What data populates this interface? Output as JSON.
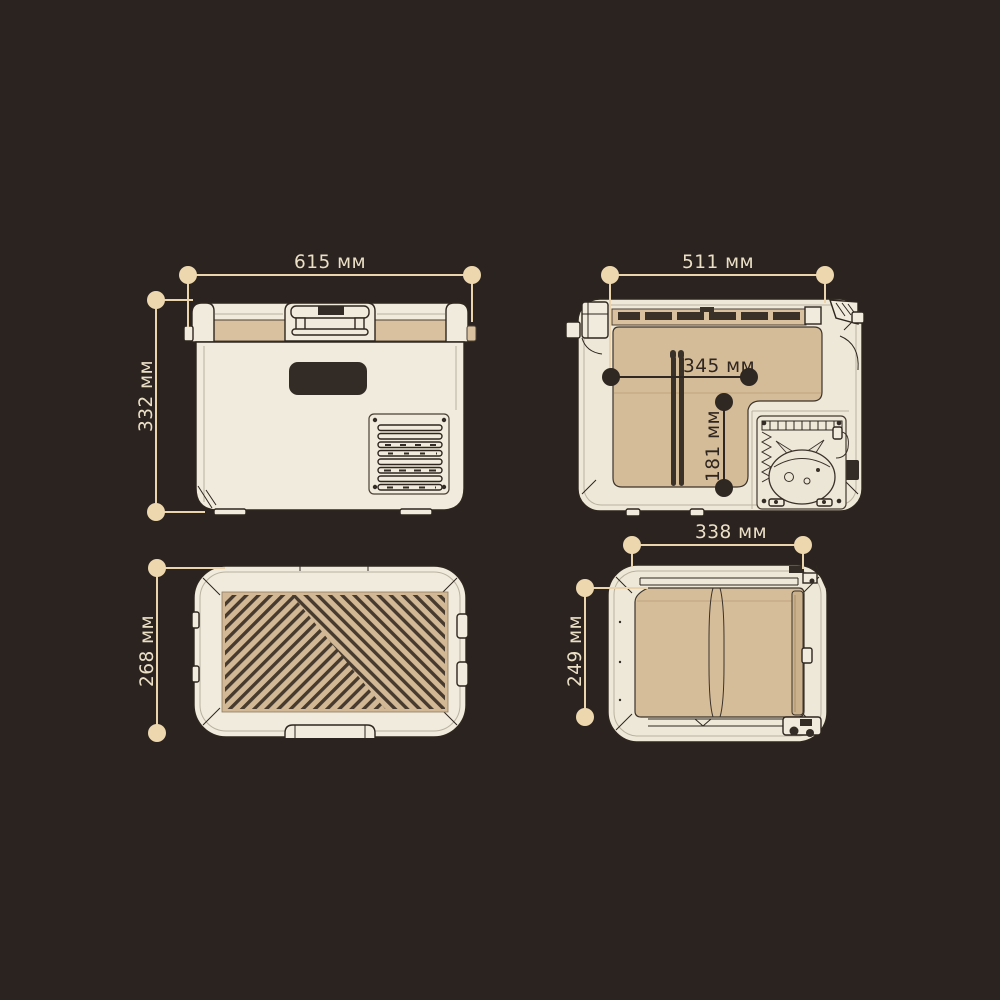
{
  "dims": {
    "front_width": "615 мм",
    "front_height": "332 мм",
    "top_width": "511 мм",
    "top_inner_width": "345 мм",
    "top_inner_depth": "181 мм",
    "lid_depth": "268 мм",
    "side_depth": "338 мм",
    "side_panel_height": "249 мм"
  },
  "colors": {
    "background": "#2b2320",
    "body_cream": "#f0ebdc",
    "accent_tan": "#d6bd9a",
    "outline_dark": "#2e261f",
    "dimension_light": "#ecd7ae",
    "dimension_dark": "#2f2722"
  }
}
